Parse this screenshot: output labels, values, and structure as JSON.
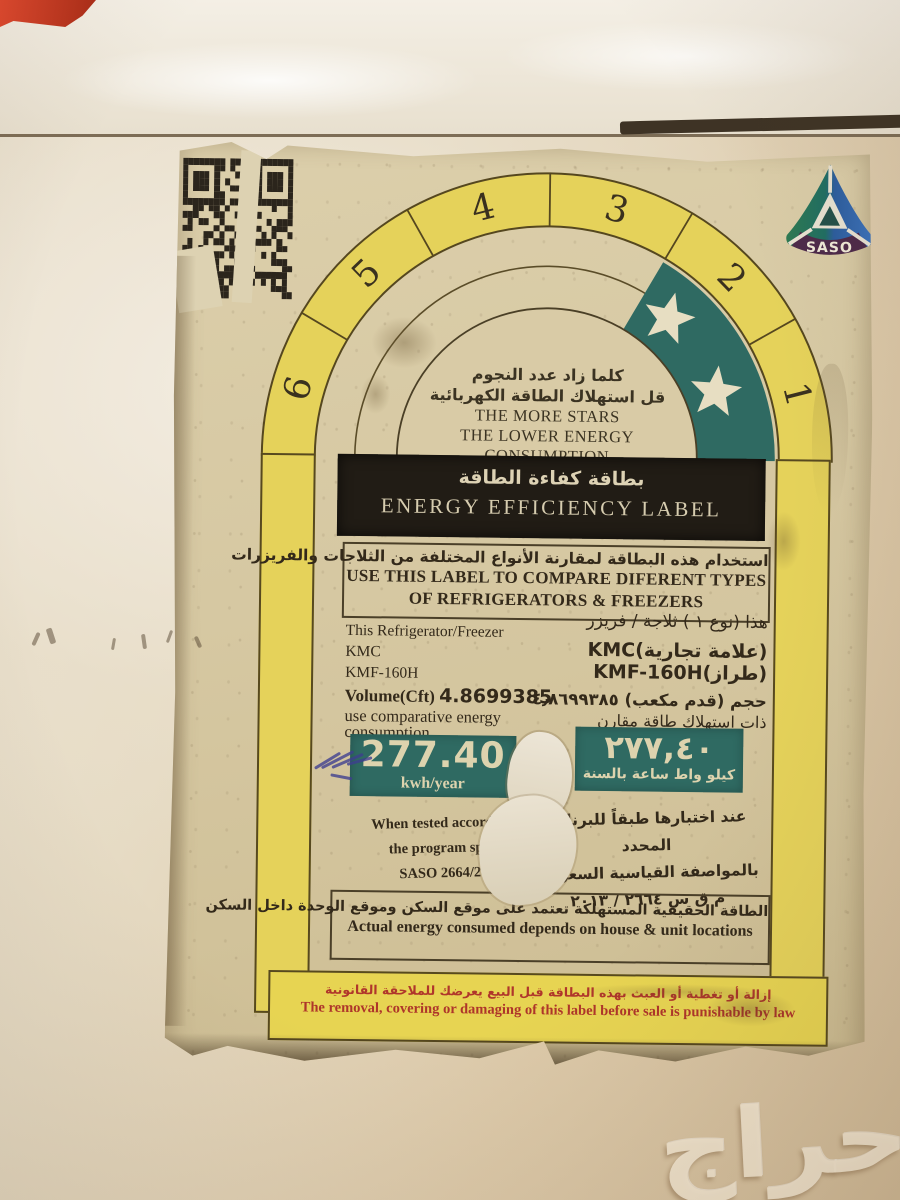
{
  "watermark_text": "حراج",
  "saso_logo_text": "SASO",
  "colors": {
    "band_yellow": "#e5d25a",
    "star_teal": "#2f6a62",
    "paper": "#d6c8a2",
    "banner_black": "#211c15",
    "legal_red": "#b0362b"
  },
  "arch": {
    "segments": [
      "6",
      "5",
      "4",
      "3",
      "2",
      "1"
    ],
    "star_count": 2,
    "tagline_ar_1": "كلما زاد عدد النجوم",
    "tagline_ar_2": "قل استهلاك الطاقة الكهربائية",
    "tagline_en_1": "THE MORE STARS",
    "tagline_en_2": "THE LOWER ENERGY CONSUMPTION"
  },
  "banner": {
    "title_ar": "بطاقة كفاءة الطاقة",
    "title_en": "ENERGY EFFICIENCY LABEL"
  },
  "compare_box": {
    "ar": "استخدام هذه البطاقة لمقارنة الأنواع المختلفة من الثلاجات والفريزرات",
    "en_1": "USE THIS LABEL TO COMPARE DIFERENT TYPES",
    "en_2": "OF REFRIGERATORS & FREEZERS"
  },
  "product": {
    "en": {
      "line1": "This Refrigerator/Freezer",
      "brand": "KMC",
      "model": "KMF-160H",
      "volume_label": "Volume(Cft)",
      "volume_value": "4.8699385",
      "note_1": "use comparative energy",
      "note_2": "consumption"
    },
    "ar": {
      "line1": "هذا (نوع ١ ) ثلاجة / فريزر",
      "brand": "KMC(علامة تجارية)",
      "model": "KMF-160H(طراز)",
      "volume": "حجم (قدم مكعب) ٤٫٨٦٩٩٣٨٥",
      "note": "ذات استهلاك طاقة مقارن"
    }
  },
  "energy": {
    "value_en": "277.40",
    "unit_en": "kwh/year",
    "value_ar": "٢٧٧,٤٠",
    "unit_ar": "كيلو واط ساعة بالسنة"
  },
  "tested": {
    "en_1": "When tested according t",
    "en_2": "the program specif",
    "en_3": "SASO 2664/201",
    "ar_1": "عند اختبارها طبقاً للبرنامج المحدد",
    "ar_2": "بالمواصفة القياسية السعودية",
    "ar_3": "م ق س ٢٦٦٤ / ٢٠١٣"
  },
  "actual": {
    "ar": "الطاقة الحقيقية المستهلكة تعتمد على موقع السكن وموقع الوحدة داخل السكن",
    "en": "Actual energy consumed depends on house & unit locations"
  },
  "legal": {
    "ar": "إزالة أو تغطية أو العبث بهذه البطاقة قبل البيع يعرضك للملاحقة القانونية",
    "en": "The removal, covering or damaging of this label before sale is punishable by law"
  }
}
